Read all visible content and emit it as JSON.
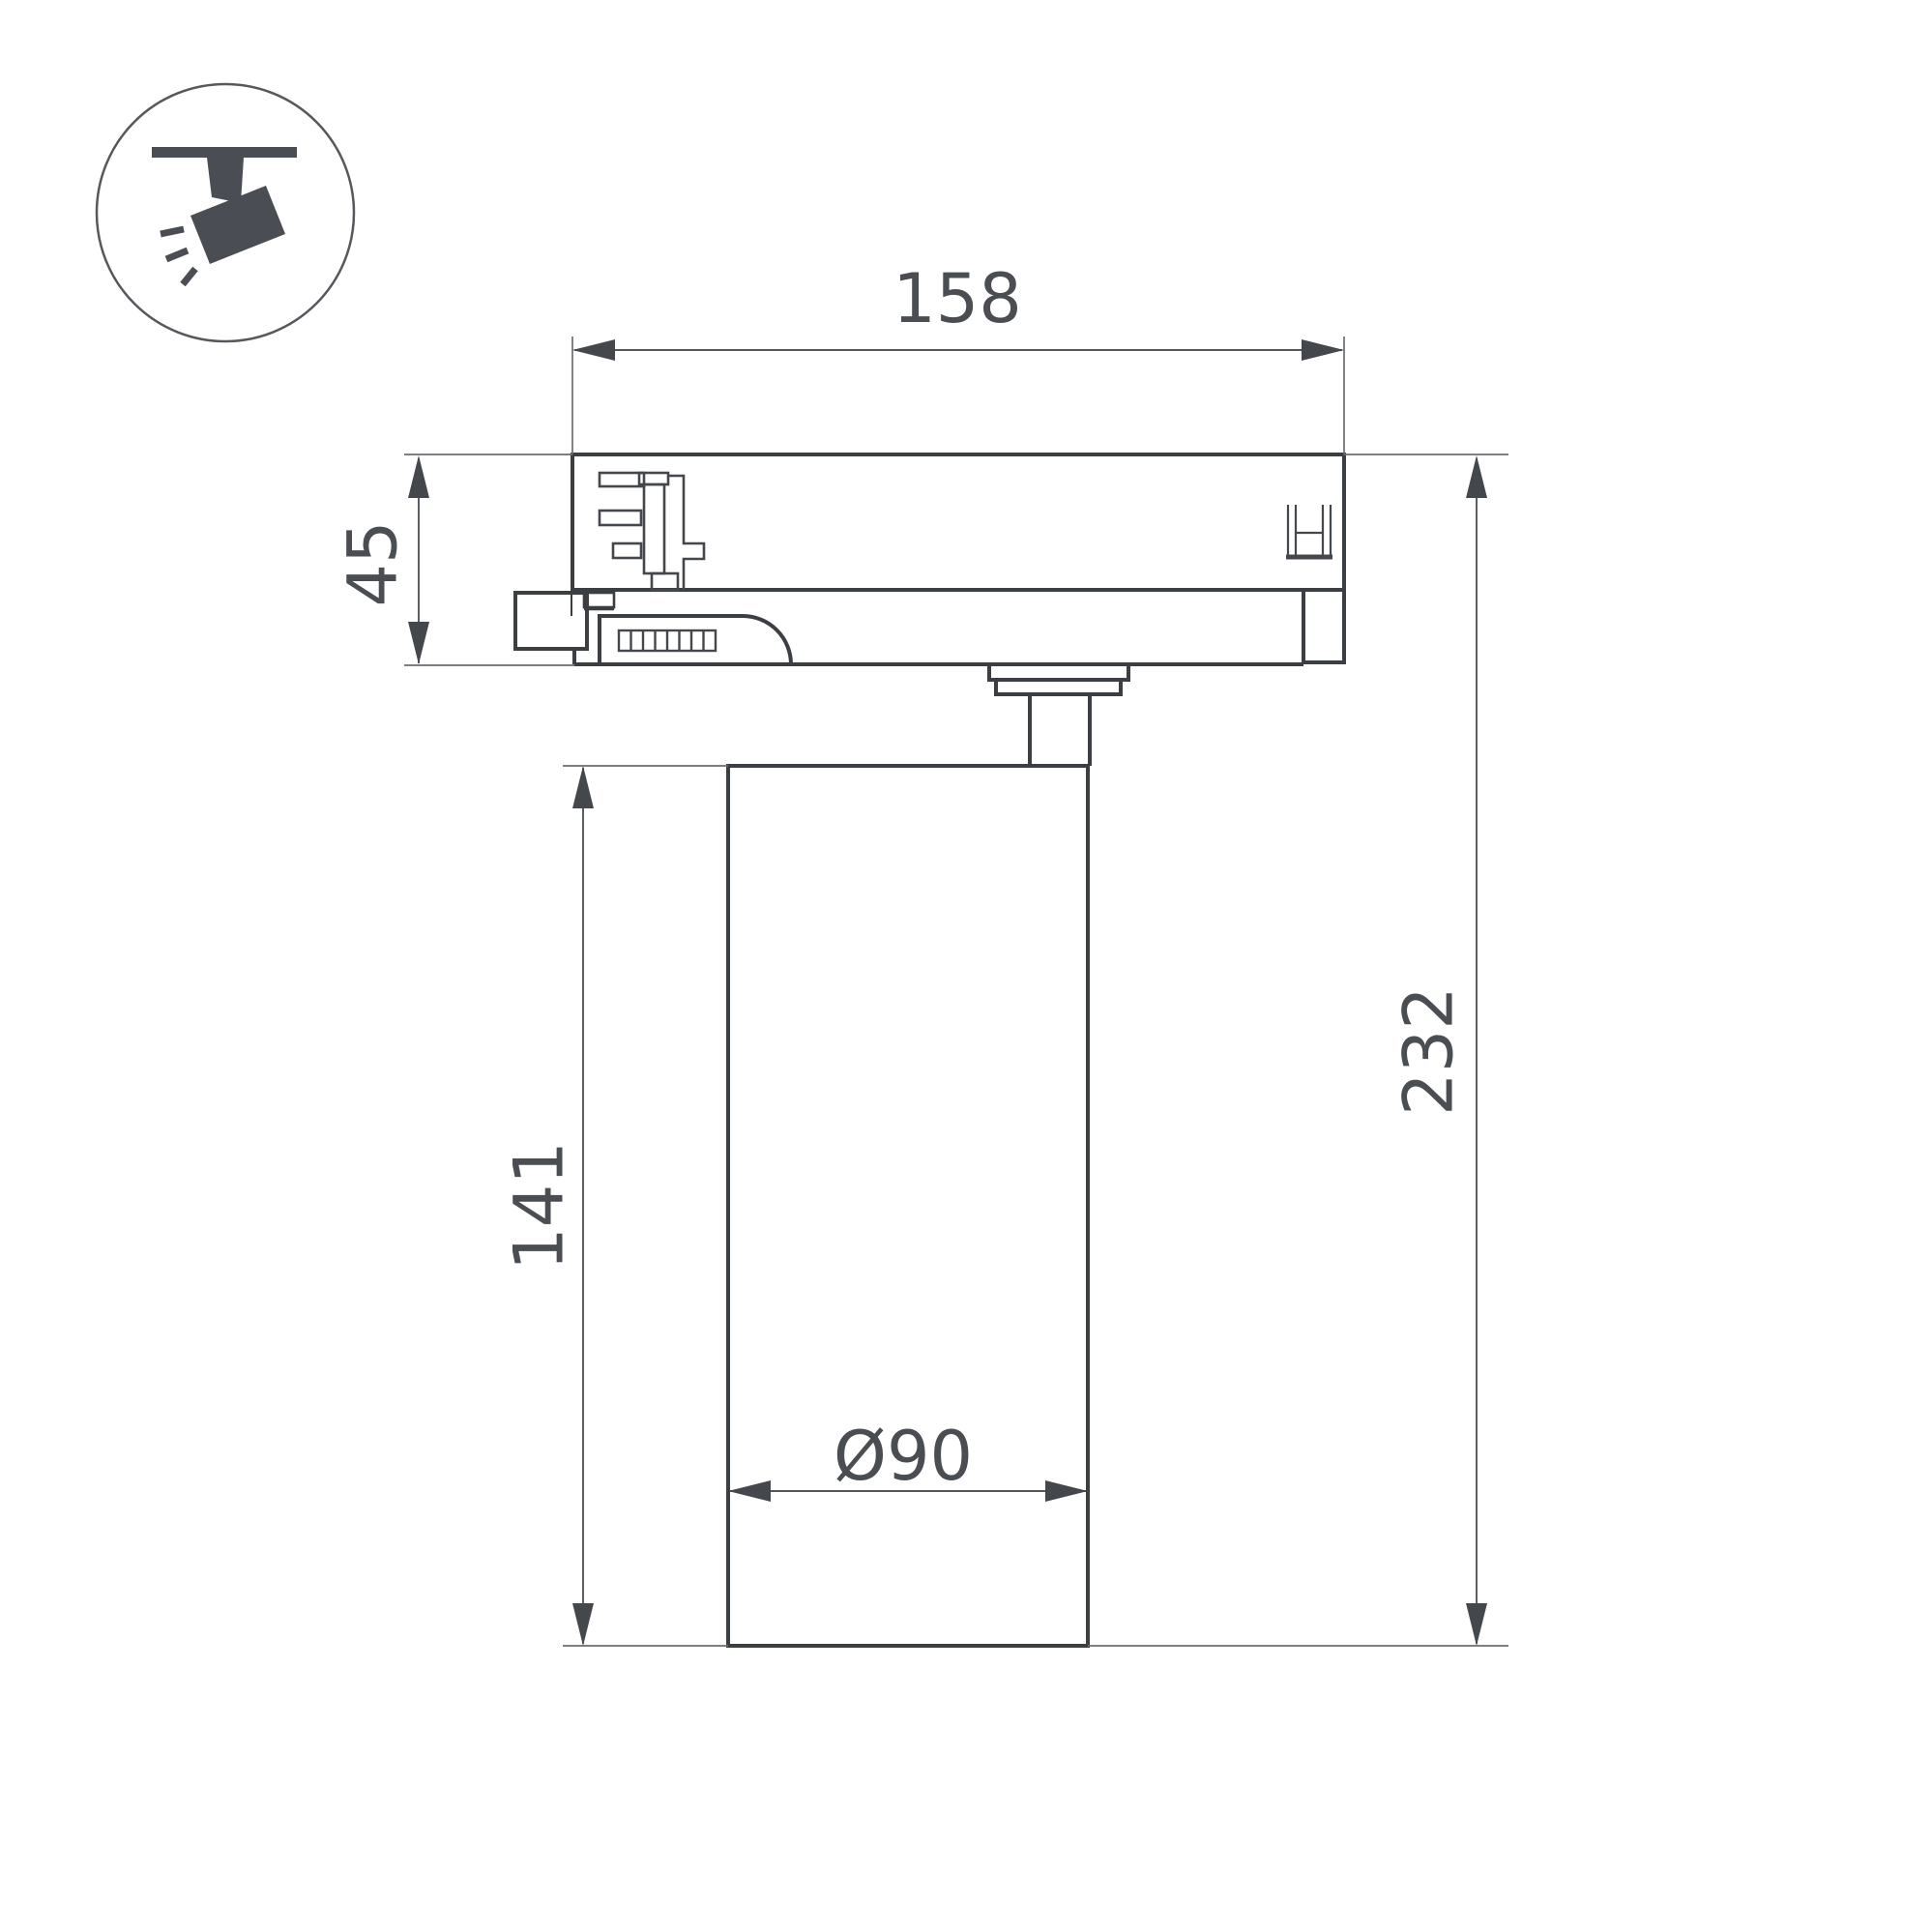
{
  "drawing": {
    "type": "technical-dimension-drawing",
    "subject": "track-mounted cylindrical spotlight, side view",
    "icon": {
      "name": "track-spotlight-icon"
    },
    "dimensions": {
      "adapter_width": "158",
      "adapter_height": "45",
      "body_height": "141",
      "total_height": "232",
      "body_diameter": "Ø90"
    },
    "colors": {
      "background": "#ffffff",
      "outline": "#3b3e43",
      "detail": "#44474c",
      "dimension_line": "#54575c",
      "extension_line": "#6a6d72",
      "text": "#4a4d52",
      "icon_fill": "#4a4e54",
      "icon_circle": "#55585c"
    }
  }
}
